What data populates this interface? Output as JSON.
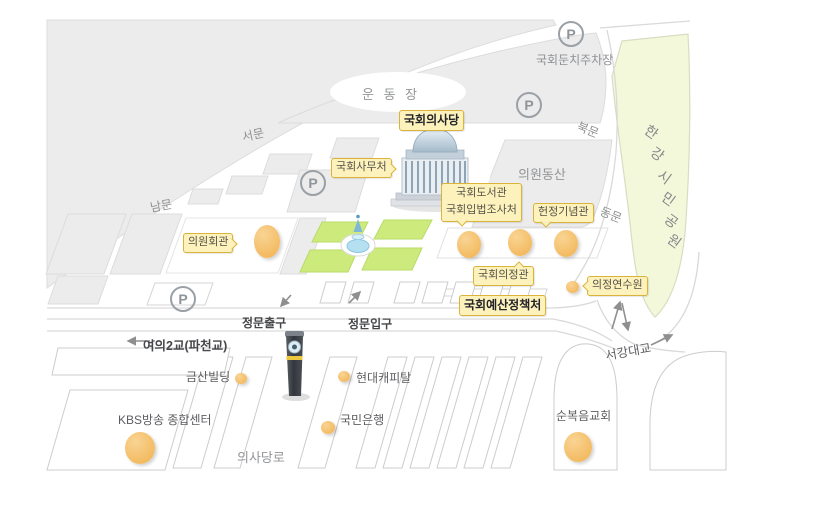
{
  "map": {
    "title": "국회의사당 주변 안내도",
    "facility_labels": {
      "assembly_hall": "국회의사당",
      "secretariat": "국회사무처",
      "members_hall": "의원회관",
      "library_line1": "국회도서관",
      "library_line2": "국회입법조사처",
      "memorial_hall": "헌정기념관",
      "uijeong_hall": "국회의정관",
      "budget_office": "국회예산정책처",
      "training_institute": "의정연수원"
    },
    "gates": {
      "west": "서문",
      "south": "남문",
      "north": "북문",
      "east": "동문"
    },
    "areas": {
      "sports_field": "운 동 장",
      "members_hill": "의원동산",
      "riverside_parking": "국회둔치주차장",
      "han_river_park_chars": [
        "한",
        "강",
        "시",
        "민",
        "공",
        "원"
      ],
      "uisadang_road": "의사당로"
    },
    "roads": {
      "main_gate_exit": "정문출구",
      "main_gate_entrance": "정문입구",
      "yeoui_bridge": "여의2교(파천교)",
      "seogang_bridge": "서강대교"
    },
    "nearby": {
      "geumsan_building": "금산빌딩",
      "hyundai_capital": "현대캐피탈",
      "kookmin_bank": "국민은행",
      "kbs_center": "KBS방송 종합센터",
      "full_gospel_church": "순복음교회"
    },
    "icons": {
      "parking": "P"
    },
    "colors": {
      "block_gray": "#ececec",
      "outline_gray": "#d9d9d9",
      "park_green": "#cdeb7d",
      "river_park_green": "#f4f8da",
      "building_orange": "#f3ba60",
      "label_bg": "#fdf2bb",
      "label_border": "#d9b33c",
      "pond_blue": "#b5e0f2"
    }
  }
}
